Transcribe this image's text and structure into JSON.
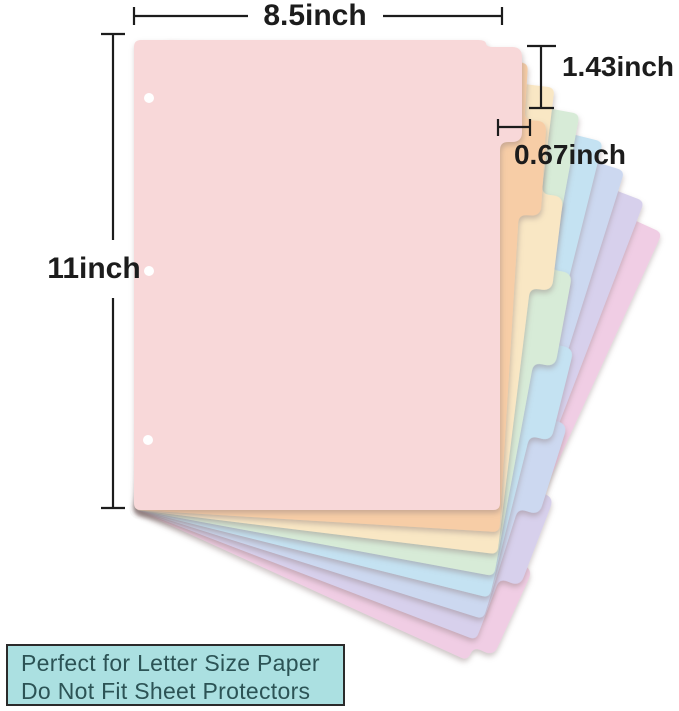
{
  "figure": {
    "kind": "product-dimension-diagram",
    "subject": "8-tab pastel letter-size binder divider set"
  },
  "dimensions": {
    "width_label": "8.5inch",
    "height_label": "11inch",
    "tab_height_label": "1.43inch",
    "tab_depth_label": "0.67inch"
  },
  "sheets": [
    {
      "id": "divider-sheet-1-pink",
      "color": "#f8d8d9"
    },
    {
      "id": "divider-sheet-2-peach",
      "color": "#f7cda6"
    },
    {
      "id": "divider-sheet-3-cream",
      "color": "#f9e7c4"
    },
    {
      "id": "divider-sheet-4-green",
      "color": "#d7ebd7"
    },
    {
      "id": "divider-sheet-5-blue",
      "color": "#c4e2f2"
    },
    {
      "id": "divider-sheet-6-periwinkle",
      "color": "#ccd8f0"
    },
    {
      "id": "divider-sheet-7-lavender",
      "color": "#d7d0ec"
    },
    {
      "id": "divider-sheet-8-magenta",
      "color": "#f0cde4"
    }
  ],
  "punch_holes": {
    "count": 3,
    "color": "#ffffff"
  },
  "colors": {
    "annotation": "#1c1c1c",
    "background": "#ffffff"
  },
  "note_box": {
    "line1": "Perfect for Letter Size Paper",
    "line2": "Do Not Fit Sheet Protectors",
    "background": "#abe0e1",
    "border_color": "#2b2b2b",
    "text_color": "#2c5355"
  }
}
